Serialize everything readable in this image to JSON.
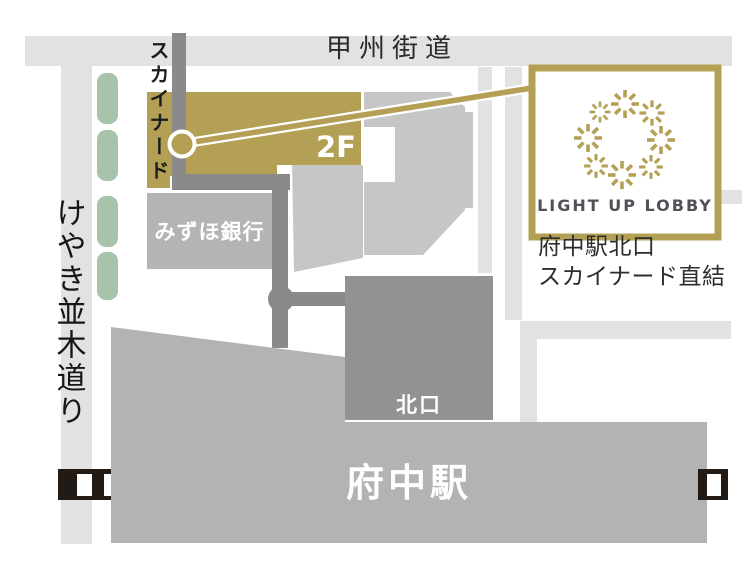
{
  "roads": {
    "koshu_kaido": "甲州街道",
    "keyaki_namiki": "けやき並木道り"
  },
  "walkway": {
    "skynard": "スカイナード",
    "floor": "2F"
  },
  "buildings": {
    "mizuho_bank": "みずほ銀行",
    "north_exit": "北口",
    "station": "府中駅"
  },
  "logo": {
    "brand": "LIGHT UP LOBBY",
    "caption_line1": "府中駅北口",
    "caption_line2": "スカイナード直結",
    "icon": "sparkle-wreath-icon"
  },
  "colors": {
    "gold": "#b3a054",
    "road": "#e2e2e2",
    "building": "#c6c6c6",
    "building_dark": "#929292",
    "path_dark": "#8a8a8a",
    "station": "#b3b3b3",
    "mizuho": "#b4b4b4",
    "green": "#a7c3ac",
    "rail_black": "#221a14",
    "white": "#ffffff"
  }
}
